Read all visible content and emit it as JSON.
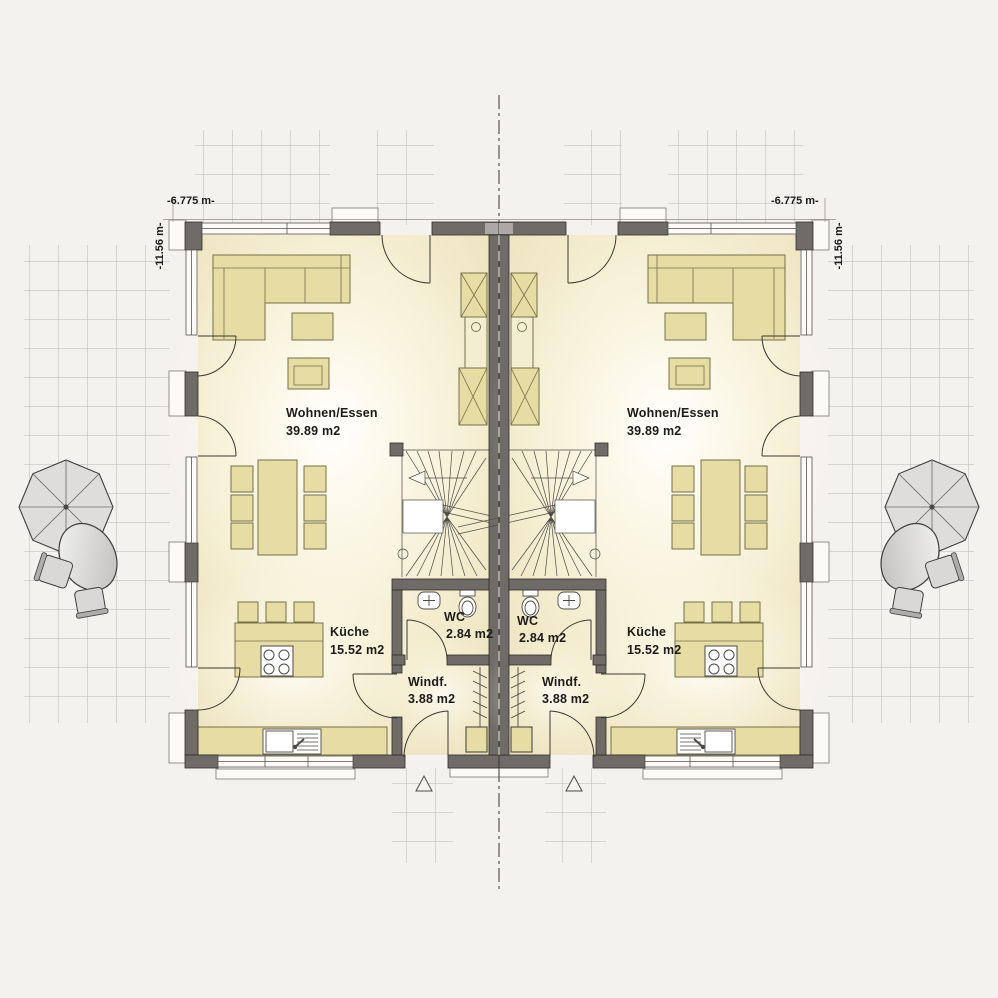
{
  "plan_type": "ground-floor plan, semi-detached house, two mirrored units",
  "dimension_labels": {
    "width_left": "-6.775 m-",
    "width_right": "-6.775 m-",
    "depth_left": "-11.56 m-",
    "depth_right": "-11.56 m-"
  },
  "units": [
    {
      "label": "left",
      "rooms": {
        "living": {
          "name": "Wohnen/Essen",
          "area": "39.89 m2"
        },
        "kitchen": {
          "name": "Küche",
          "area": "15.52 m2"
        },
        "wc": {
          "name": "WC",
          "area": "2.84 m2"
        },
        "vestibule": {
          "name": "Windf.",
          "area": "3.88 m2"
        }
      }
    },
    {
      "label": "right",
      "rooms": {
        "living": {
          "name": "Wohnen/Essen",
          "area": "39.89 m2"
        },
        "kitchen": {
          "name": "Küche",
          "area": "15.52 m2"
        },
        "wc": {
          "name": "WC",
          "area": "2.84 m2"
        },
        "vestibule": {
          "name": "Windf.",
          "area": "3.88 m2"
        }
      }
    }
  ],
  "colors": {
    "background": "#f4f2ef",
    "wall": "#6f6c68",
    "wall_outline": "#2f2d2a",
    "floor_center": "#fdfbf0",
    "floor_edge": "#eae0ba",
    "furniture_fill": "#e6dca4",
    "furniture_outline": "#77714a",
    "grid_line": "#b8b6b2",
    "fixture_white": "#ffffff",
    "garden_furniture": "#dedddb"
  }
}
